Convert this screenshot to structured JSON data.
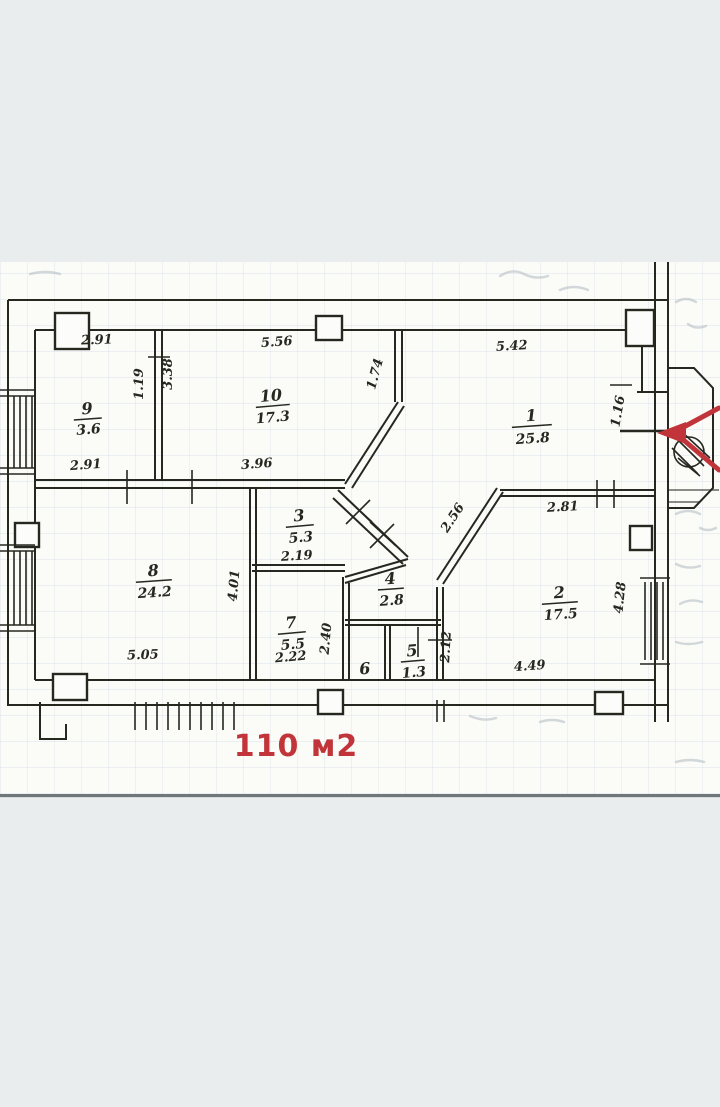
{
  "scan": {
    "total_area": {
      "text": "110 м2"
    },
    "rooms": [
      {
        "number": "1",
        "area": "25.8"
      },
      {
        "number": "2",
        "area": "17.5"
      },
      {
        "number": "3",
        "area": "5.3"
      },
      {
        "number": "4",
        "area": "2.8"
      },
      {
        "number": "5",
        "area": "1.3"
      },
      {
        "number": "6",
        "area": ""
      },
      {
        "number": "7",
        "area": "5.5"
      },
      {
        "number": "8",
        "area": "24.2"
      },
      {
        "number": "9",
        "area": "3.6"
      },
      {
        "number": "10",
        "area": "17.3"
      }
    ],
    "dimensions": {
      "top_room9": "2.91",
      "top_room10": "5.56",
      "top_room1": "5.42",
      "room9_width": "2.91",
      "room10_width": "3.96",
      "partition_left": "1.19",
      "partition_right": "3.38",
      "room1_left_wall": "1.74",
      "room1_right_niche": "1.16",
      "room2_diagonal": "2.56",
      "room2_top": "2.81",
      "hall_height": "4.01",
      "room3_width": "2.19",
      "room8_bottom": "5.05",
      "room7_bottom": "2.22",
      "block_left": "2.40",
      "block_right": "2.12",
      "room2_bottom": "4.49",
      "room2_right": "4.28"
    }
  },
  "colors": {
    "ink": "#26271f",
    "annotation_red": "#c0343a",
    "paper": "#fbfbf8",
    "background": "#e9edee"
  }
}
